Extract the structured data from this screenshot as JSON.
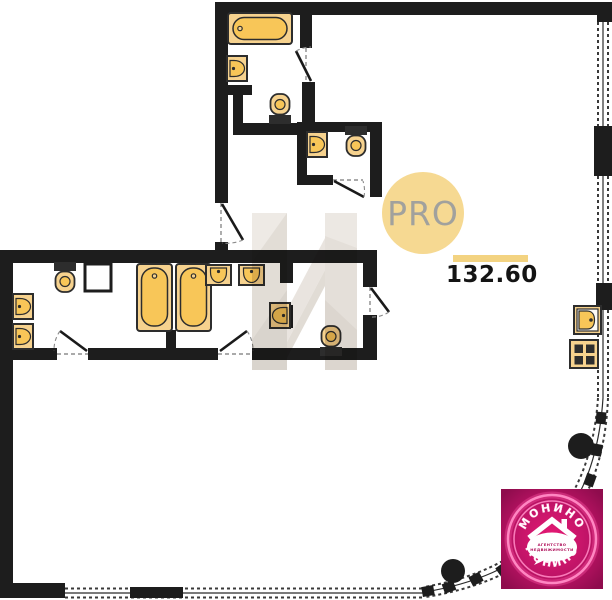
{
  "badge": {
    "label": "PRO"
  },
  "area": {
    "value": "132.60"
  },
  "logo": {
    "name_top": "МОНИНО",
    "name_bottom": "МОНИНО",
    "tagline_line1": "АГЕНТСТВО",
    "tagline_line2": "НЕДВИЖИМОСТИ"
  },
  "colors": {
    "wall": "#1d1d1d",
    "fixture_base": "#f6d28e",
    "fixture_accent": "#f8c658",
    "badge_yellow": "#f6d992",
    "area_underline": "#f3d381",
    "logo_magenta": "#c01467",
    "logo_ring": "#ff86c2",
    "watermark_tan": "#d0c8bd"
  },
  "plan": {
    "fixtures": [
      "bathtub-horizontal",
      "wall-sink",
      "toilet",
      "wc-sink",
      "wc-toilet",
      "laundry-toilet",
      "utility-shaft",
      "wall-sink",
      "wall-sink",
      "bathtub-vertical",
      "bathtub-vertical",
      "counter-sink",
      "counter-sink",
      "divider-sink",
      "toilet",
      "kitchen-sink",
      "stove-4-burner"
    ],
    "structural_columns": 2,
    "doors": 6,
    "glazing": "dashed-window-walls with curved corner"
  }
}
